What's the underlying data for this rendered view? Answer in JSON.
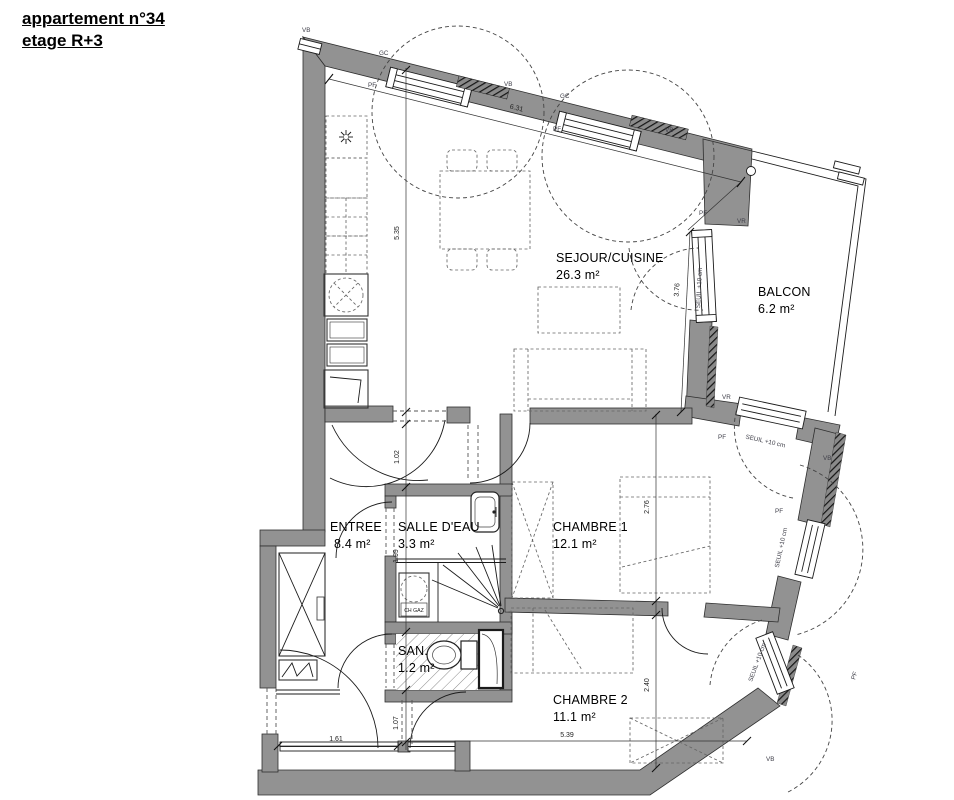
{
  "title": {
    "line1": "appartement n°34",
    "line2": "etage R+3"
  },
  "rooms": {
    "sejour": {
      "name": "SEJOUR/CUISINE",
      "area": "26.3 m²"
    },
    "balcon": {
      "name": "BALCON",
      "area": "6.2 m²"
    },
    "entree": {
      "name": "ENTREE",
      "area": "8.4 m²"
    },
    "salle_deau": {
      "name": "SALLE D'EAU",
      "area": "3.3 m²"
    },
    "chambre1": {
      "name": "CHAMBRE 1",
      "area": "12.1 m²"
    },
    "san": {
      "name": "SAN.",
      "area": "1.2 m²"
    },
    "chambre2": {
      "name": "CHAMBRE 2",
      "area": "11.1 m²"
    }
  },
  "dimensions": {
    "top_wall": "6.31",
    "sejour_height": "5.35",
    "hall_opening": "1.02",
    "bath_width": "1.99",
    "passage": "1.07",
    "chambre1_depth": "2.76",
    "chambre2_depth": "2.40",
    "chambre2_width": "5.39",
    "entry_width": "1.61",
    "balcony_wall": "3.76"
  },
  "annotations": {
    "vb": "VB",
    "gc": "GC",
    "pf": "PF",
    "vr": "VR",
    "seuil": "SEUIL +10 cm",
    "ch_gaz": "CH GAZ"
  },
  "colors": {
    "wall": "#929292",
    "line": "#1a1a1a",
    "label": "#3e3e48"
  }
}
